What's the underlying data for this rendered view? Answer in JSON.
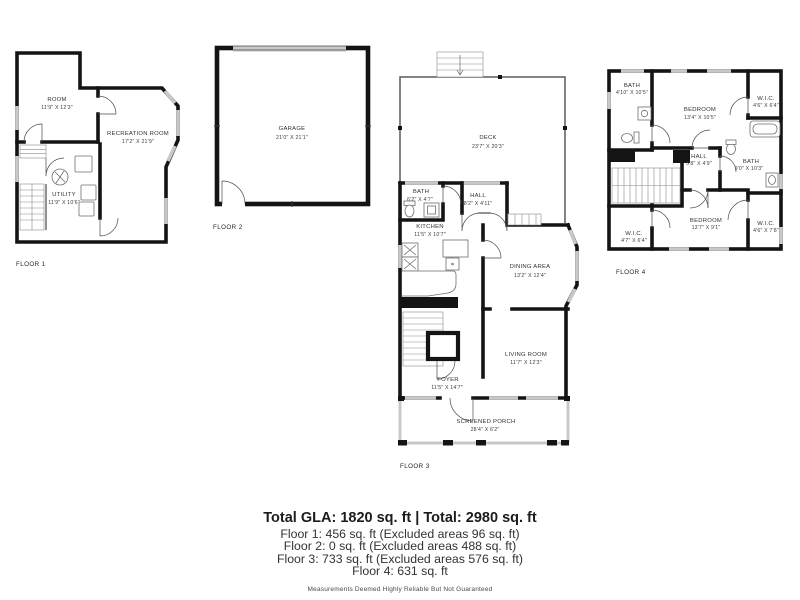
{
  "floors": [
    {
      "label": "FLOOR 1",
      "rooms": [
        {
          "name": "ROOM",
          "dims": "11'9\" X 12'3\""
        },
        {
          "name": "RECREATION ROOM",
          "dims": "17'2\" X 21'9\""
        },
        {
          "name": "UTILITY",
          "dims": "11'9\" X 10'6\""
        }
      ]
    },
    {
      "label": "FLOOR 2",
      "rooms": [
        {
          "name": "GARAGE",
          "dims": "21'0\" X 21'1\""
        }
      ]
    },
    {
      "label": "FLOOR 3",
      "rooms": [
        {
          "name": "DECK",
          "dims": "23'7\" X 20'3\""
        },
        {
          "name": "BATH",
          "dims": "6'2\" X 4'7\""
        },
        {
          "name": "HALL",
          "dims": "8'2\" X 4'11\""
        },
        {
          "name": "KITCHEN",
          "dims": "11'5\" X 10'7\""
        },
        {
          "name": "DINING AREA",
          "dims": "13'2\" X 12'4\""
        },
        {
          "name": "LIVING ROOM",
          "dims": "11'7\" X 12'3\""
        },
        {
          "name": "FOYER",
          "dims": "11'5\" X 14'7\""
        },
        {
          "name": "SCREENED PORCH",
          "dims": "28'4\" X 6'2\""
        }
      ]
    },
    {
      "label": "FLOOR 4",
      "rooms": [
        {
          "name": "BATH",
          "dims": "4'10\" X 10'5\""
        },
        {
          "name": "BEDROOM",
          "dims": "13'4\" X 10'5\""
        },
        {
          "name": "W.I.C.",
          "dims": "4'6\" X 6'4\""
        },
        {
          "name": "HALL",
          "dims": "5'8\" X 4'9\""
        },
        {
          "name": "BATH",
          "dims": "9'0\" X 10'3\""
        },
        {
          "name": "W.I.C.",
          "dims": "4'7\" X 6'4\""
        },
        {
          "name": "BEDROOM",
          "dims": "13'7\" X 9'1\""
        },
        {
          "name": "W.I.C.",
          "dims": "4'6\" X 7'8\""
        }
      ]
    }
  ],
  "summary": {
    "total": "Total GLA: 1820 sq. ft | Total: 2980 sq. ft",
    "lines": [
      "Floor 1: 456 sq. ft (Excluded areas 96 sq. ft)",
      "Floor 2: 0 sq. ft (Excluded areas 488 sq. ft)",
      "Floor 3: 733 sq. ft (Excluded areas 576 sq. ft)",
      "Floor 4: 631 sq. ft"
    ],
    "disclaimer": "Measurements Deemed Highly Reliable But Not Guaranteed"
  },
  "colors": {
    "wall": "#141414",
    "window": "#c8c8c8",
    "door": "#4a4a4a",
    "text": "#3c3c3c"
  }
}
